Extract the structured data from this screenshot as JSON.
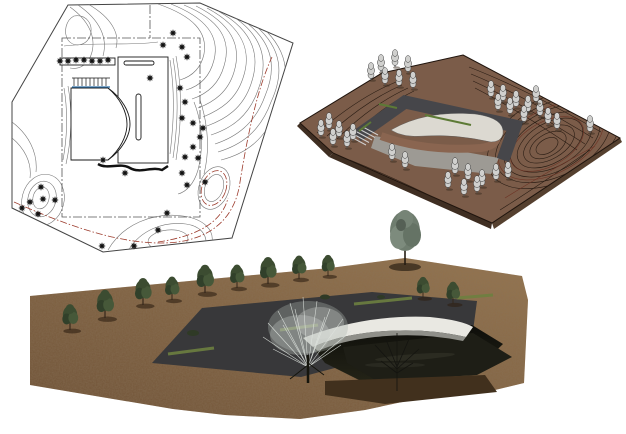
{
  "page": {
    "background": "#ffffff"
  },
  "figures": {
    "site_plan": {
      "name": "contour-site-plan",
      "tree_symbol_count": 36,
      "colors": {
        "paper": "#ffffff",
        "line": "#777777",
        "boundary": "#444444",
        "building": "#1a1a1a",
        "red_contour": "#9c3b2c",
        "blue": "#2e6fa8",
        "tree": "#111111",
        "property_line": "#555555"
      }
    },
    "terrain_model": {
      "name": "3d-contour-terrain-model",
      "tree_count": 35,
      "colors": {
        "ground": "#7b5c49",
        "ground_side": "#3f2e22",
        "ground_side_right": "#55402f",
        "contour": "#2a1d14",
        "contour_red": "#6e3425",
        "deck": "#46464a",
        "roof": "#dcd9d1",
        "court_floor": "#9d9a94",
        "court_wall": "#8a6550",
        "tree": "#d0d0ce",
        "strip": "#5d7a36",
        "stair": "#cfcfcf"
      }
    },
    "rendering": {
      "name": "3d-site-rendering",
      "tree_count": 13,
      "colors": {
        "dirt_light": "#97764f",
        "dirt_dark": "#6b4e33",
        "deck": "#38383a",
        "strip": "#6d8040",
        "tree": "#3c4c31",
        "tall_tree": "#6f7d6f",
        "pond": "#1e1e16",
        "shadow_mass": "#0e0e0a",
        "roof_white": "#e9e8e2",
        "silver_tree": "#d6dcd6",
        "twig": "#141410"
      }
    }
  }
}
